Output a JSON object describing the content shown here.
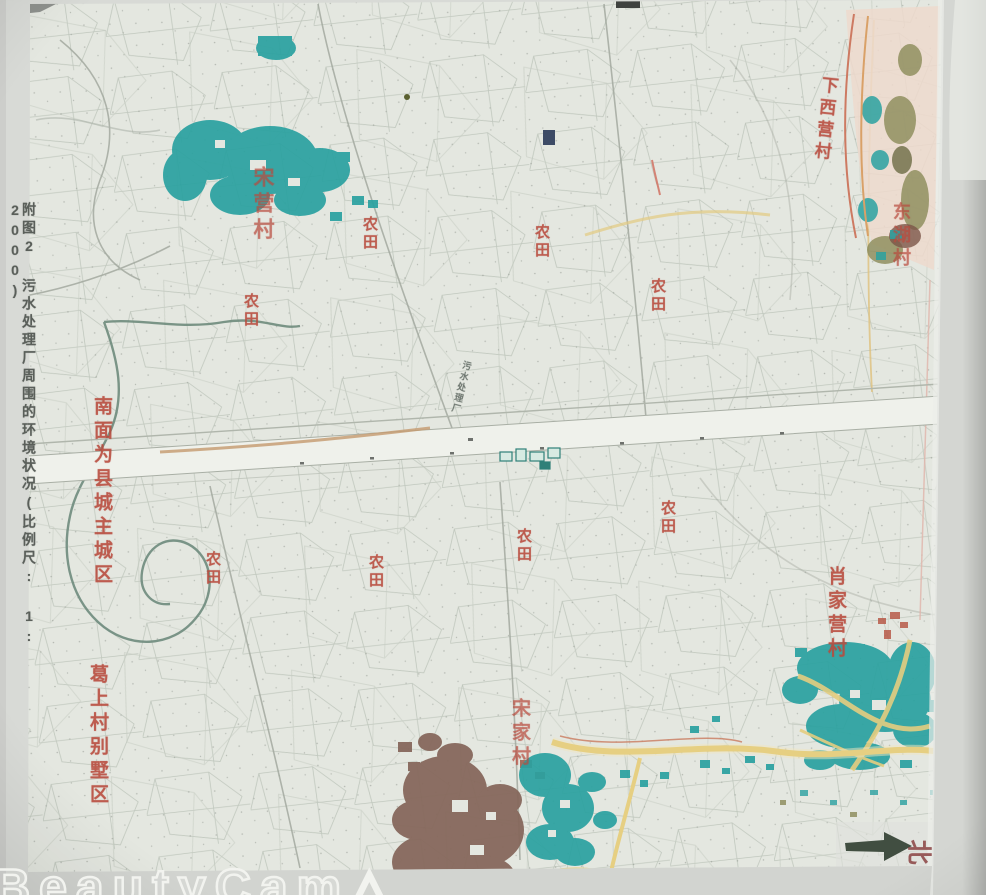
{
  "page": {
    "caption_vertical": "附图2 污水处理厂周围的环境状况(比例尺: 1: 2000)",
    "watermark_text": "BeautyCam",
    "watermark_icon": "△"
  },
  "map": {
    "labels": {
      "village_top_left": "宋营村",
      "village_top_right": "下西营村",
      "village_right_upper": "东湖村",
      "village_right_mid": "肖家营村",
      "village_bottom_center": "宋家村",
      "villa_district_bottom_left": "葛上村别墅区",
      "county_seat_note": "南面为县城主城区",
      "farmland": "农田",
      "sewage_plant": "污水处理厂",
      "north_char": "北"
    },
    "colors": {
      "village_fill_teal": "#2aa1a0",
      "label_red": "#b84c3e",
      "built_up_brown": "#86685c",
      "road_yellow": "#e6cf82",
      "river_green": "#6e8b7d",
      "map_paper": "#e4e7e0"
    }
  }
}
